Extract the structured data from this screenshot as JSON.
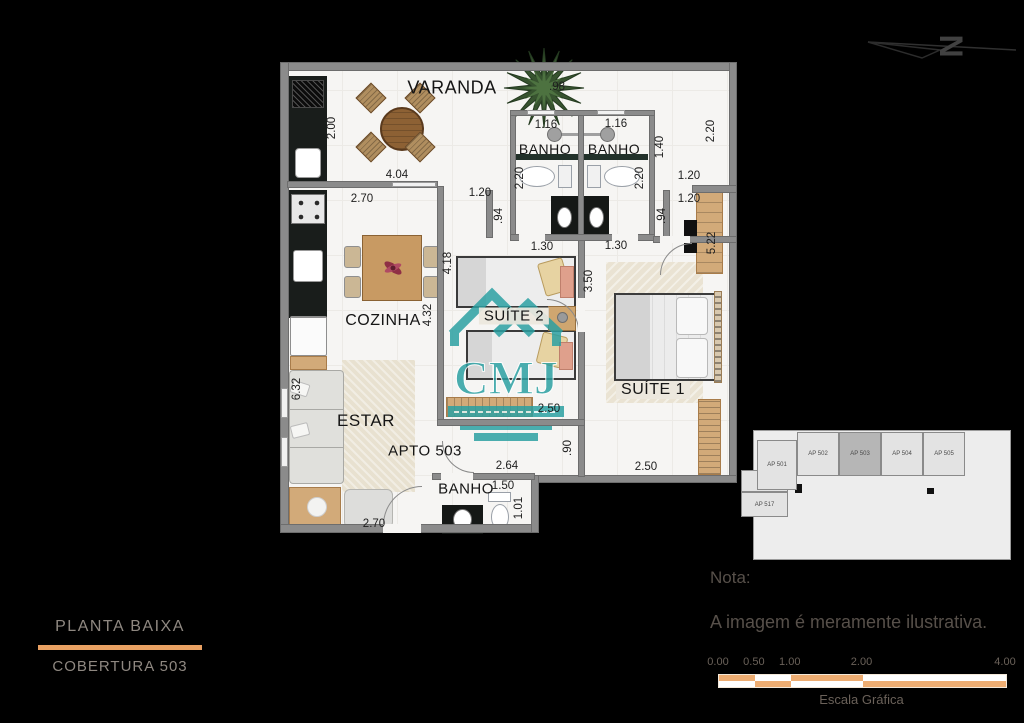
{
  "north": {
    "letter": "N"
  },
  "plan": {
    "apartment_label": "APTO 503",
    "room_labels": [
      {
        "text": "VARANDA",
        "x": 452,
        "y": 88,
        "size": 18
      },
      {
        "text": "BANHO",
        "x": 545,
        "y": 149,
        "size": 14
      },
      {
        "text": "BANHO",
        "x": 614,
        "y": 149,
        "size": 14
      },
      {
        "text": "COZINHA",
        "x": 383,
        "y": 321,
        "size": 16
      },
      {
        "text": "SUÍTE 2",
        "x": 514,
        "y": 316,
        "size": 15,
        "chip": true
      },
      {
        "text": "ESTAR",
        "x": 366,
        "y": 421,
        "size": 17
      },
      {
        "text": "APTO 503",
        "x": 425,
        "y": 451,
        "size": 15
      },
      {
        "text": "SUÍTE 1",
        "x": 653,
        "y": 390,
        "size": 16,
        "chip": true
      },
      {
        "text": "BANHO",
        "x": 466,
        "y": 489,
        "size": 15
      }
    ],
    "measurements": [
      {
        "text": ".98",
        "x": 557,
        "y": 87
      },
      {
        "text": "1.16",
        "x": 546,
        "y": 125
      },
      {
        "text": "1.16",
        "x": 616,
        "y": 124
      },
      {
        "text": "4.04",
        "x": 397,
        "y": 175
      },
      {
        "text": "2.70",
        "x": 362,
        "y": 199
      },
      {
        "text": "1.20",
        "x": 480,
        "y": 193
      },
      {
        "text": "1.20",
        "x": 689,
        "y": 176
      },
      {
        "text": "1.20",
        "x": 689,
        "y": 199
      },
      {
        "text": "1.30",
        "x": 542,
        "y": 247
      },
      {
        "text": "1.30",
        "x": 616,
        "y": 246
      },
      {
        "text": "2.50",
        "x": 549,
        "y": 409
      },
      {
        "text": "2.64",
        "x": 507,
        "y": 466
      },
      {
        "text": "2.50",
        "x": 646,
        "y": 467
      },
      {
        "text": "1.50",
        "x": 503,
        "y": 486
      },
      {
        "text": "2.70",
        "x": 374,
        "y": 524
      },
      {
        "text": "2.00",
        "x": 332,
        "y": 128,
        "vertical": true
      },
      {
        "text": "2.20",
        "x": 520,
        "y": 178,
        "vertical": true
      },
      {
        "text": "2.20",
        "x": 640,
        "y": 178,
        "vertical": true
      },
      {
        "text": "1.40",
        "x": 660,
        "y": 147,
        "vertical": true
      },
      {
        "text": "2.20",
        "x": 711,
        "y": 131,
        "vertical": true
      },
      {
        "text": ".94",
        "x": 499,
        "y": 216,
        "vertical": true
      },
      {
        "text": ".94",
        "x": 662,
        "y": 216,
        "vertical": true
      },
      {
        "text": "5.22",
        "x": 712,
        "y": 243,
        "vertical": true
      },
      {
        "text": "4.18",
        "x": 448,
        "y": 263,
        "vertical": true
      },
      {
        "text": "4.32",
        "x": 428,
        "y": 315,
        "vertical": true
      },
      {
        "text": "3.50",
        "x": 589,
        "y": 281,
        "vertical": true
      },
      {
        "text": "6.32",
        "x": 297,
        "y": 389,
        "vertical": true
      },
      {
        "text": ".90",
        "x": 568,
        "y": 448,
        "vertical": true
      },
      {
        "text": "1.01",
        "x": 519,
        "y": 508,
        "vertical": true
      }
    ]
  },
  "watermark": {
    "text": "CMJ",
    "color": "#2aa0a2"
  },
  "keyplan": {
    "units": [
      {
        "label": "AP 501",
        "x": 16,
        "y": 12,
        "w": 40,
        "h": 50,
        "highlight": false
      },
      {
        "label": "AP 502",
        "x": 56,
        "y": 4,
        "w": 42,
        "h": 44,
        "highlight": false
      },
      {
        "label": "AP 503",
        "x": 98,
        "y": 4,
        "w": 42,
        "h": 44,
        "highlight": true
      },
      {
        "label": "AP 504",
        "x": 140,
        "y": 4,
        "w": 42,
        "h": 44,
        "highlight": false
      },
      {
        "label": "AP 505",
        "x": 182,
        "y": 4,
        "w": 42,
        "h": 44,
        "highlight": false
      },
      {
        "label": "AP 517",
        "x": 0,
        "y": 64,
        "w": 47,
        "h": 25,
        "highlight": false
      }
    ]
  },
  "footer": {
    "title": "PLANTA BAIXA",
    "subtitle": "COBERTURA 503",
    "accent": "#e9a163"
  },
  "note": {
    "heading": "Nota:",
    "body": "A imagem é meramente ilustrativa."
  },
  "scale": {
    "ticks": [
      {
        "label": "0.00",
        "m": 0
      },
      {
        "label": "0.50",
        "m": 0.5
      },
      {
        "label": "1.00",
        "m": 1
      },
      {
        "label": "2.00",
        "m": 2
      },
      {
        "label": "4.00",
        "m": 4
      }
    ],
    "segments_m": [
      0,
      0.5,
      1,
      2,
      4
    ],
    "total_m": 4,
    "orange": "#eead72",
    "caption": "Escala Gráfica"
  }
}
